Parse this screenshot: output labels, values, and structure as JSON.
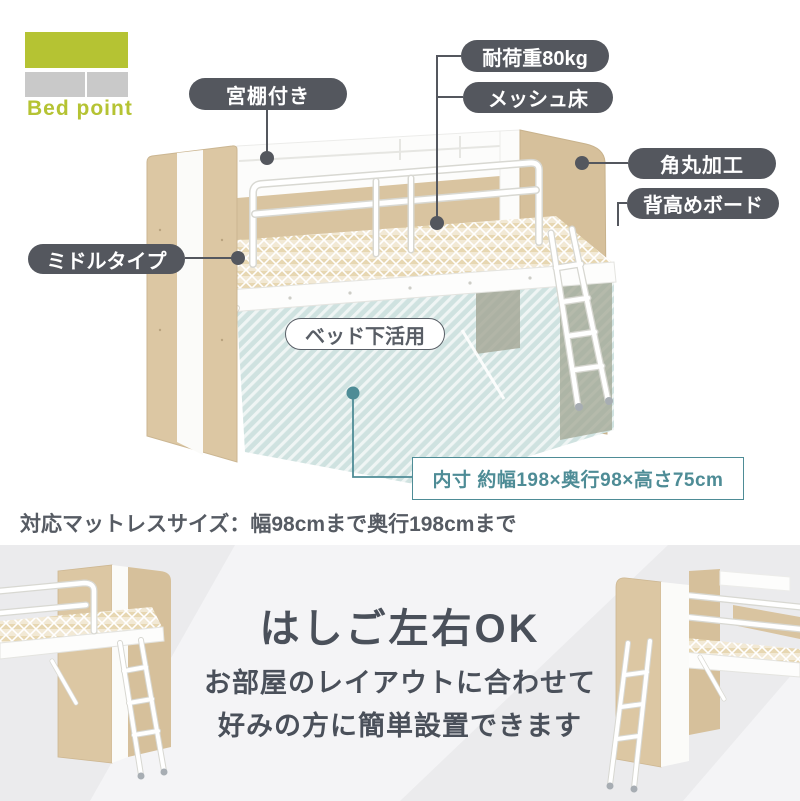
{
  "logo": {
    "label": "Bed point"
  },
  "callouts": {
    "shelf": "宮棚付き",
    "load": "耐荷重80kg",
    "mesh": "メッシュ床",
    "rounded": "角丸加工",
    "tall_board": "背高めボード",
    "middle": "ミドルタイプ",
    "under_bed": "ベッド下活用",
    "inner_size": "内寸 約幅198×奥行98×高さ75cm"
  },
  "notes": {
    "mattress": "対応マットレスサイズ：幅98cmまで奥行198cmまで"
  },
  "bottom_panel": {
    "heading": "はしご左右OK",
    "desc_line1": "お部屋のレイアウトに合わせて",
    "desc_line2": "好みの方に簡単設置できます"
  },
  "colors": {
    "accent_green": "#b5c333",
    "logo_gray": "#c9c9c9",
    "callout_dark": "#54575e",
    "teal_accent": "#4e8c96",
    "hatch_teal": "#cfe2e0",
    "wood": "#dcc7a3",
    "bottom_bg": "#ebebed"
  }
}
